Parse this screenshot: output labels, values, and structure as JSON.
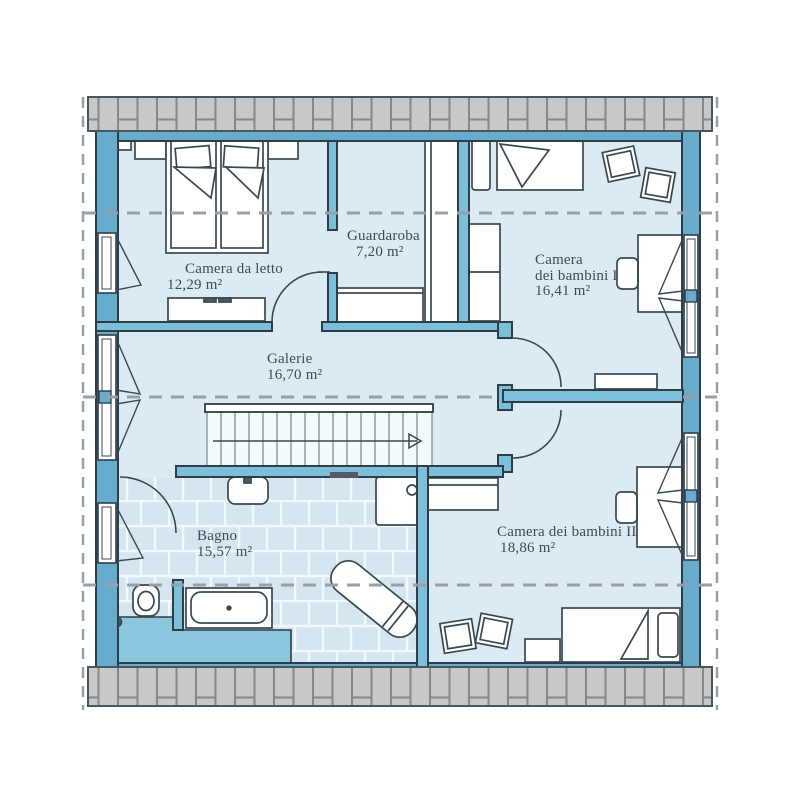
{
  "plan": {
    "type": "floor-plan",
    "language": "Italian",
    "rooms": [
      {
        "id": "camera-da-letto",
        "lines": [
          "Camera da letto"
        ],
        "area": "12,29 m²"
      },
      {
        "id": "guardaroba",
        "lines": [
          "Guardaroba"
        ],
        "area": "7,20 m²"
      },
      {
        "id": "camera-dei-bambini-1",
        "lines": [
          "Camera",
          "dei bambini I"
        ],
        "area": "16,41 m²"
      },
      {
        "id": "galerie",
        "lines": [
          "Galerie"
        ],
        "area": "16,70 m²"
      },
      {
        "id": "bagno",
        "lines": [
          "Bagno"
        ],
        "area": "15,57 m²"
      },
      {
        "id": "camera-dei-bambini-2",
        "lines": [
          "Camera dei bambini II"
        ],
        "area": "18,86 m²"
      }
    ],
    "colors": {
      "exterior_wall": "#67ACCD",
      "interior_wall": "#7CBFDA",
      "knee_wall_zone": "#8AC6DE",
      "floor": "#DCEAF4",
      "bath_tile": "#D5E6F1",
      "roof_hatch": "#C8C8C8",
      "outline": "#2E3D46",
      "dashed_line": "#98A0A5",
      "text": "#3C4B56"
    }
  }
}
